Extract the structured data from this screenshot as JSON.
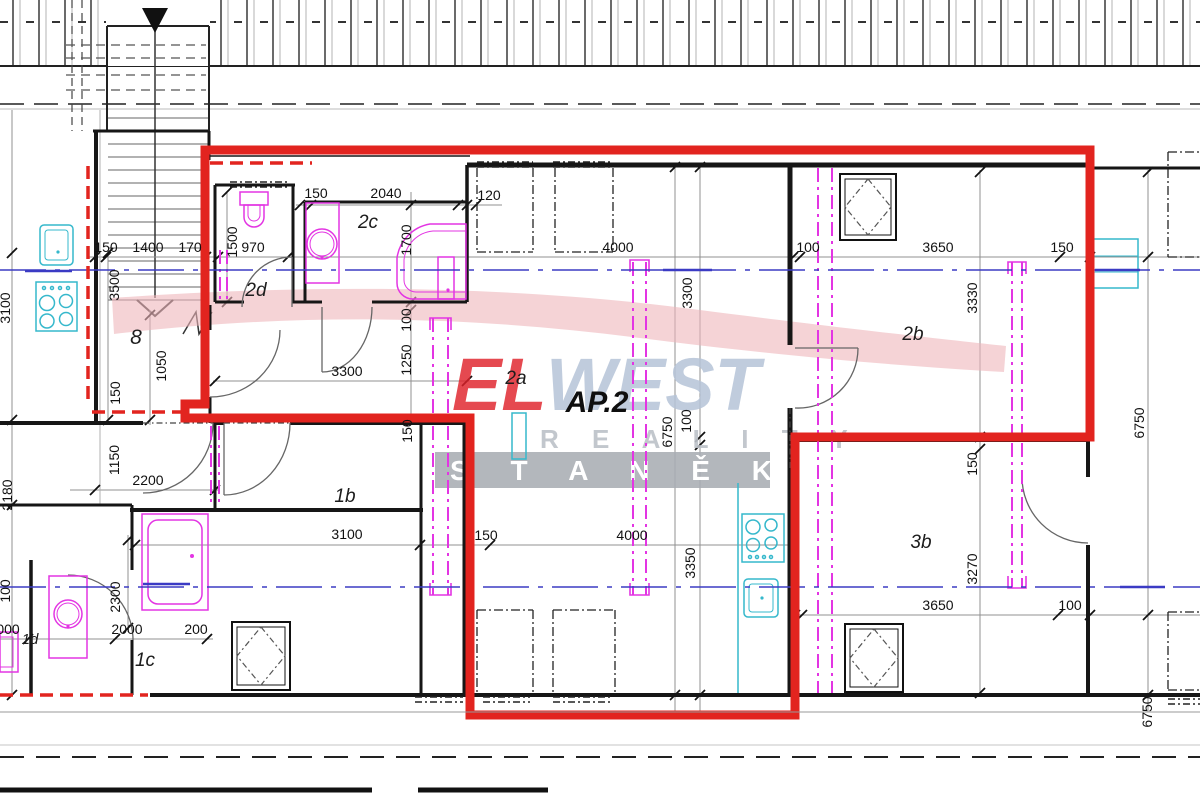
{
  "plan": {
    "highlight_label": "AP.2",
    "rooms": {
      "r8": "8",
      "r2d": "2d",
      "r2c": "2c",
      "r2a": "2a",
      "r2b": "2b",
      "r1b": "1b",
      "r1c": "1c",
      "r1d": "1d",
      "r3b": "3b"
    },
    "dims": [
      "150",
      "1400",
      "170",
      "970",
      "100",
      "3650",
      "150",
      "150",
      "2040",
      "120",
      "4000",
      "3300",
      "3100",
      "2200",
      "2000",
      "200",
      "000",
      "4000",
      "150",
      "3650",
      "100",
      "1500",
      "1700",
      "100",
      "1250",
      "3500",
      "3100",
      "1050",
      "150",
      "1150",
      "2180",
      "150",
      "3300",
      "100",
      "6750",
      "3350",
      "3330",
      "150",
      "3270",
      "6750",
      "6750",
      "100",
      "2300"
    ],
    "colors": {
      "highlight_red": "#e2241f",
      "fixture_magenta": "#e335e3",
      "fixture_cyan": "#35b8cc",
      "axis_blue": "#3b3bc4",
      "watermark_pink": "#efb6ba",
      "watermark_blue": "#b6c4d8",
      "watermark_band": "#a8adb3"
    }
  },
  "watermark": {
    "el": "EL",
    "west": "WEST",
    "reality": "R E A L I T Y",
    "stanek": "S T A N Ě K"
  }
}
